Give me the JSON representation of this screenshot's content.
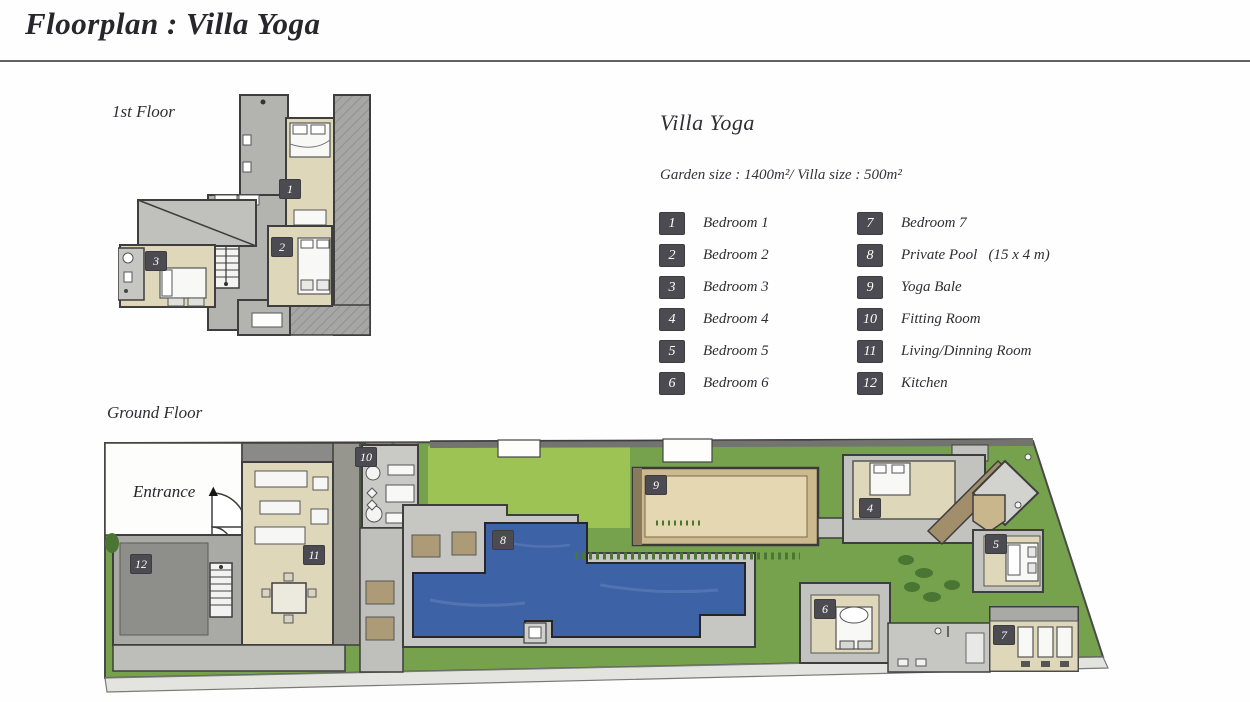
{
  "page": {
    "title": "Floorplan : Villa Yoga"
  },
  "floors": {
    "first": {
      "label": "1st Floor"
    },
    "ground": {
      "label": "Ground Floor",
      "entrance": "Entrance",
      "entrance_arrow": "▲"
    }
  },
  "info": {
    "title": "Villa Yoga",
    "size_line": "Garden size : 1400m²/ Villa size : 500m²"
  },
  "legend": {
    "items": [
      {
        "num": "1",
        "label": "Bedroom 1"
      },
      {
        "num": "2",
        "label": "Bedroom 2"
      },
      {
        "num": "3",
        "label": "Bedroom 3"
      },
      {
        "num": "4",
        "label": "Bedroom 4"
      },
      {
        "num": "5",
        "label": "Bedroom 5"
      },
      {
        "num": "6",
        "label": "Bedroom 6"
      },
      {
        "num": "7",
        "label": "Bedroom 7"
      },
      {
        "num": "8",
        "label": "Private Pool   (15 x 4 m)"
      },
      {
        "num": "9",
        "label": "Yoga Bale"
      },
      {
        "num": "10",
        "label": "Fitting Room"
      },
      {
        "num": "11",
        "label": "Living/Dinning Room"
      },
      {
        "num": "12",
        "label": "Kitchen"
      }
    ]
  },
  "colors": {
    "badge_bg": "#4b4b51",
    "badge_text": "#ffffff",
    "pool_blue": "#3d62a5",
    "grass_green": "#76a24e",
    "grass_light": "#9dc355",
    "room_beige": "#ded7ba",
    "deck_gray": "#c6c6c3",
    "roof_gray": "#a6a6a4",
    "bale_tan": "#cdb98e",
    "wall_dark": "#3e3e3e"
  }
}
